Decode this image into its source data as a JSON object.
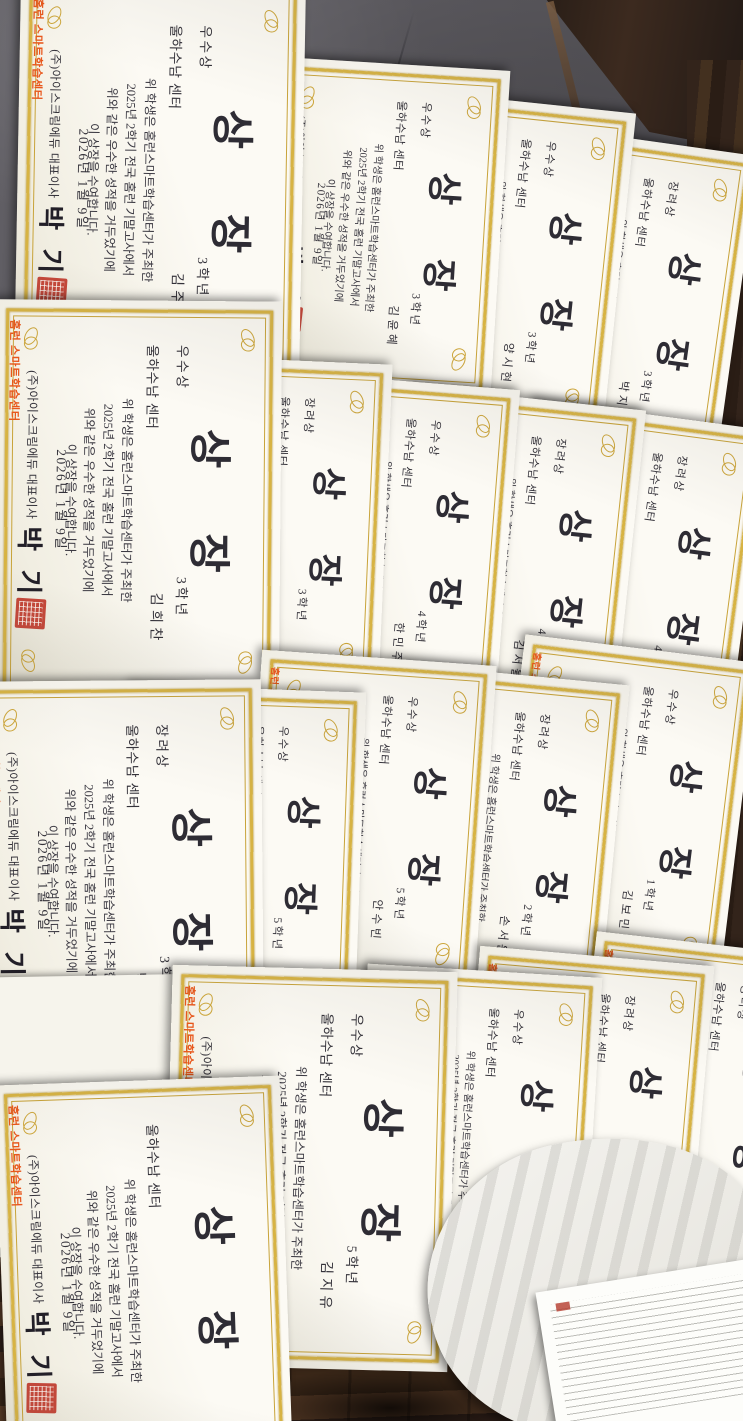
{
  "colors": {
    "gold_border": "#d7b343",
    "paper": "#fcfaf4",
    "ink": "#34323a",
    "seal_red": "#c23b2e",
    "logo_orange": "#e8571c",
    "wall_gray": "#5b595e",
    "wood_brown": "#3a2718"
  },
  "certificate_common": {
    "title": [
      "상",
      "장"
    ],
    "organization_line": "울하수남 센터",
    "body_lines": [
      "위 학생은 홈런스마트학습센터가 주최한",
      "2025년 2학기 전국 홈런 기말고사에서",
      "위와 같은 우수한 성적을 거두었기에",
      "이 상장을 수여합니다."
    ],
    "date_line": "2026년 1월 9일",
    "issuer_line": "(주)아이스크림에듀 대표이사",
    "signature": "박 기",
    "logo_text": "홈런 스마트학습센터"
  },
  "award_types": [
    "우수상",
    "장려상"
  ],
  "certificates": [
    {
      "award": "우수상",
      "grade": "3학년",
      "student": "김주혁"
    },
    {
      "award": "우수상",
      "grade": "3학년",
      "student": "김윤혜"
    },
    {
      "award": "우수상",
      "grade": "3학년",
      "student": "양시현"
    },
    {
      "award": "장려상",
      "grade": "3학년",
      "student": "박지훈"
    },
    {
      "award": "우수상",
      "grade": "3학년",
      "student": "김희찬"
    },
    {
      "award": "장려상",
      "grade": "3학년",
      "student": ""
    },
    {
      "award": "우수상",
      "grade": "4학년",
      "student": "한민주"
    },
    {
      "award": "장려상",
      "grade": "4학년",
      "student": "김서율"
    },
    {
      "award": "장려상",
      "grade": "4학년",
      "student": "김은호"
    },
    {
      "award": "장려상",
      "grade": "3학년",
      "student": "박선중"
    },
    {
      "award": "우수상",
      "grade": "5학년",
      "student": "김지유"
    },
    {
      "award": "우수상",
      "grade": "5학년",
      "student": "안수빈"
    },
    {
      "award": "장려상",
      "grade": "2학년",
      "student": "손서윤"
    },
    {
      "award": "우수상",
      "grade": "1학년",
      "student": "김보민"
    },
    {
      "award": "",
      "grade": "",
      "student": ""
    },
    {
      "award": "우수상",
      "grade": "5학년",
      "student": "김지유"
    },
    {
      "award": "우수상",
      "grade": "5학년",
      "student": "임태훈"
    },
    {
      "award": "장려상",
      "grade": "6학년",
      "student": "박지민"
    },
    {
      "award": "장려상",
      "grade": "6학년",
      "student": "남연주"
    }
  ]
}
